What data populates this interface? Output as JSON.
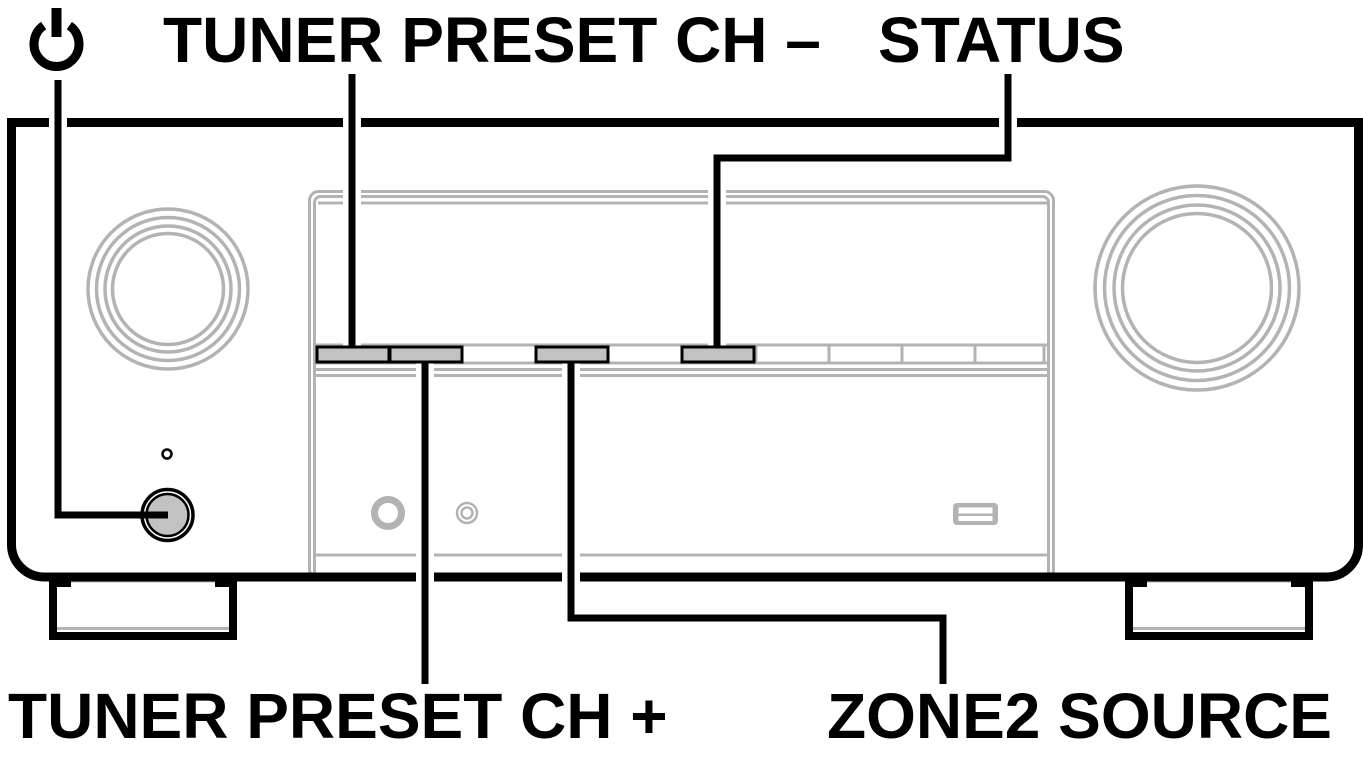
{
  "diagram": {
    "labels": {
      "tuner_preset_ch_minus": "TUNER PRESET CH –",
      "status": "STATUS",
      "tuner_preset_ch_plus": "TUNER PRESET CH +",
      "zone2_source": "ZONE2 SOURCE"
    },
    "icons": {
      "power": "power-standby-icon"
    },
    "colors": {
      "line_black": "#000000",
      "panel_outline_gray": "#b3b3b3",
      "highlight_button_fill": "#c2c2c2",
      "background": "#ffffff"
    },
    "highlighted_buttons": [
      {
        "label": "TUNER PRESET CH –",
        "callout_position": "top"
      },
      {
        "label": "TUNER PRESET CH +",
        "callout_position": "bottom"
      },
      {
        "label": "ZONE2 SOURCE",
        "callout_position": "bottom"
      },
      {
        "label": "STATUS",
        "callout_position": "top"
      }
    ]
  }
}
